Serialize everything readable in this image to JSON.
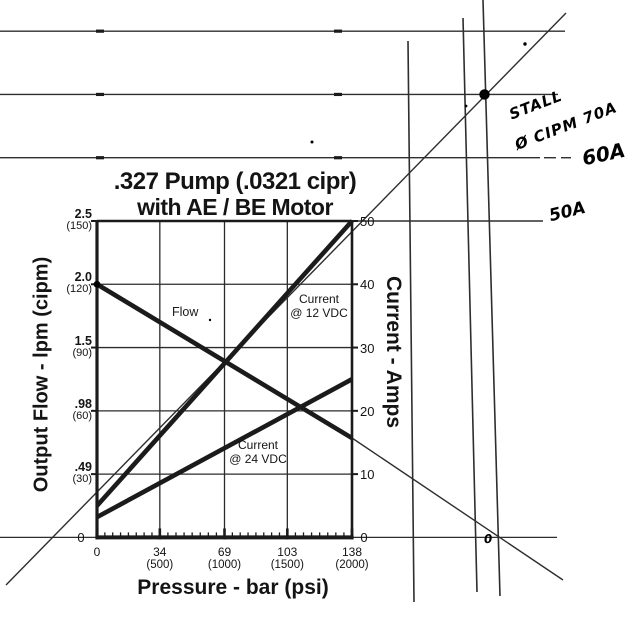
{
  "page": {
    "background": "#ffffff",
    "ink": "#1b1b1b",
    "overlay_ink": "#2e2e2e",
    "hand_ink": "#000000"
  },
  "chart_data": {
    "type": "line",
    "title": ".327 Pump (.0321 cipr)",
    "subtitle": "with AE / BE Motor",
    "x_axis": {
      "label": "Pressure - bar (psi)",
      "range_bar": [
        0,
        138
      ],
      "minor_divisions_per_interval": 8,
      "ticks": [
        {
          "v": 0,
          "bar": "0",
          "psi": ""
        },
        {
          "v": 34,
          "bar": "34",
          "psi": "(500)"
        },
        {
          "v": 69,
          "bar": "69",
          "psi": "(1000)"
        },
        {
          "v": 103,
          "bar": "103",
          "psi": "(1500)"
        },
        {
          "v": 138,
          "bar": "138",
          "psi": "(2000)"
        }
      ]
    },
    "y_left_axis": {
      "label": "Output Flow - lpm (cipm)",
      "zero": "0",
      "ticks": [
        {
          "u": 50,
          "lpm": "2.5",
          "cipm": "(150)"
        },
        {
          "u": 40,
          "lpm": "2.0",
          "cipm": "(120)"
        },
        {
          "u": 30,
          "lpm": "1.5",
          "cipm": "(90)"
        },
        {
          "u": 20,
          "lpm": ".98",
          "cipm": "(60)"
        },
        {
          "u": 10,
          "lpm": ".49",
          "cipm": "(30)"
        }
      ]
    },
    "y_right_axis": {
      "label": "Current - Amps",
      "range_amps": [
        0,
        50
      ],
      "zero": "0",
      "ticks": [
        {
          "u": 50,
          "t": "50"
        },
        {
          "u": 40,
          "t": "40"
        },
        {
          "u": 30,
          "t": "30"
        },
        {
          "u": 20,
          "t": "20"
        },
        {
          "u": 10,
          "t": "10"
        }
      ]
    },
    "grid": true,
    "series": [
      {
        "name": "flow",
        "label": "Flow",
        "x_bar": [
          0,
          138
        ],
        "y_units": [
          40,
          15.7
        ],
        "note": "left axis: 2.0 lpm (120 cipm) at 0 bar, ~0.78 lpm at 138 bar"
      },
      {
        "name": "current-12vdc",
        "label_line1": "Current",
        "label_line2": "@ 12 VDC",
        "x_bar": [
          0,
          138
        ],
        "y_units": [
          5,
          50
        ]
      },
      {
        "name": "current-24vdc",
        "label_line1": "Current",
        "label_line2": "@ 24 VDC",
        "x_bar": [
          0,
          138
        ],
        "y_units": [
          3.2,
          25
        ]
      }
    ],
    "annotations": {
      "stall_point_amps": 70,
      "extended_amp_gridlines": [
        80,
        70,
        60,
        50
      ],
      "hand_labels": {
        "stall_line1": "STALL",
        "stall_line2": "Ø CIPM 70A",
        "a60": "60A",
        "a50": "50A",
        "zero_mark": "0"
      }
    }
  },
  "overlay_px": {
    "amp_hlines": [
      {
        "amps": 80,
        "x1": 0,
        "x2": 565
      },
      {
        "amps": 70,
        "x1": 0,
        "x2": 558
      },
      {
        "amps": 60,
        "x1": 0,
        "x2": 540
      },
      {
        "amps": 50,
        "x1": 352,
        "x2": 543
      }
    ],
    "dashes": [
      {
        "amps": 60,
        "x1": 544,
        "x2": 556
      },
      {
        "amps": 60,
        "x1": 561,
        "x2": 571
      }
    ],
    "line_blobs": [
      {
        "amps": 80,
        "x": 100
      },
      {
        "amps": 80,
        "x": 338
      },
      {
        "amps": 70,
        "x": 100
      },
      {
        "amps": 70,
        "x": 338
      },
      {
        "amps": 60,
        "x": 100
      },
      {
        "amps": 60,
        "x": 338
      }
    ],
    "baseline_extension": {
      "y": 537.4,
      "x1": 0,
      "x2": 557
    },
    "vlines": [
      {
        "x1": 408,
        "y1": 41,
        "x2": 414,
        "y2": 602
      },
      {
        "x1": 463,
        "y1": 18,
        "x2": 477,
        "y2": 592
      },
      {
        "x1": 483,
        "y1": 0,
        "x2": 500,
        "y2": 596
      }
    ],
    "diagonals": [
      {
        "name": "stall-extension-line",
        "x1": 6,
        "y1": 585,
        "x2": 566,
        "y2": 13
      },
      {
        "name": "flow-extension-line",
        "x1": 352,
        "y1": 438,
        "x2": 563,
        "y2": 580
      }
    ],
    "stall_dot": {
      "x": 484.5,
      "r": 5.2
    },
    "specks": [
      {
        "x": 312,
        "y": 142,
        "r": 1.5
      },
      {
        "x": 525,
        "y": 44,
        "r": 1.7
      },
      {
        "x": 466,
        "y": 106,
        "r": 1.4
      },
      {
        "x": 210,
        "y": 320,
        "r": 1.2
      }
    ]
  }
}
